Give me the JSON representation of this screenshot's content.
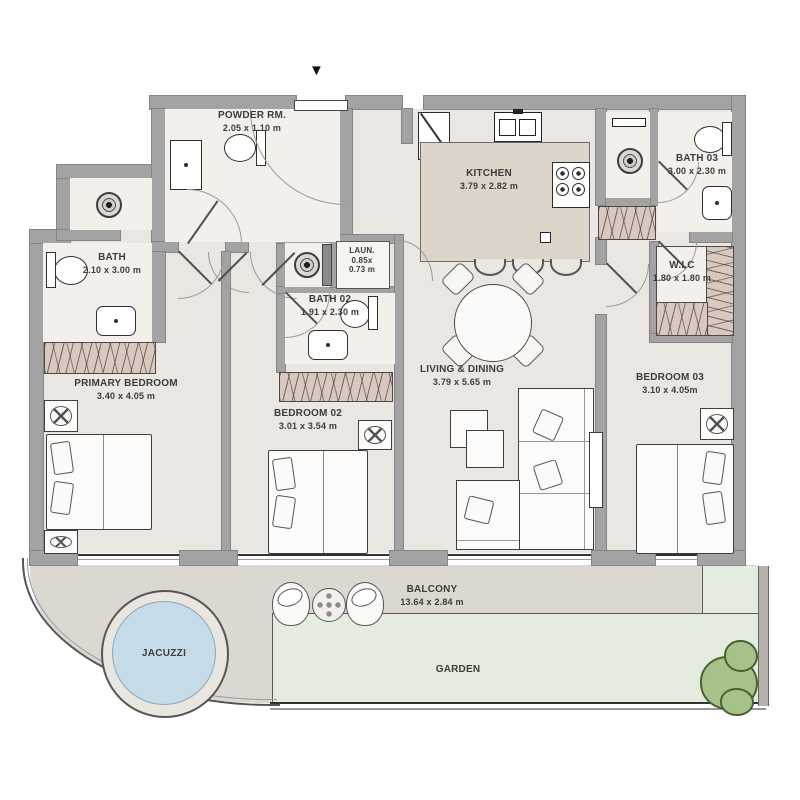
{
  "plan": {
    "entrance_marker": "▼",
    "rooms": {
      "powder": {
        "name": "POWDER RM.",
        "dims": "2.05 x 1.10 m"
      },
      "bath": {
        "name": "BATH",
        "dims": "2.10 x 3.00 m"
      },
      "laundry": {
        "name": "LAUN.",
        "dims_line1": "0.85x",
        "dims_line2": "0.73 m"
      },
      "bath02": {
        "name": "BATH 02",
        "dims": "1.91 x 2.30 m"
      },
      "bath03": {
        "name": "BATH 03",
        "dims": "3.00 x 2.30 m"
      },
      "wic": {
        "name": "W.I.C",
        "dims": "1.80 x 1.80 m"
      },
      "kitchen": {
        "name": "KITCHEN",
        "dims": "3.79 x 2.82 m"
      },
      "living": {
        "name": "LIVING & DINING",
        "dims": "3.79 x 5.65 m"
      },
      "primary": {
        "name": "PRIMARY BEDROOM",
        "dims": "3.40 x 4.05 m"
      },
      "bedroom02": {
        "name": "BEDROOM 02",
        "dims": "3.01 x 3.54 m"
      },
      "bedroom03": {
        "name": "BEDROOM 03",
        "dims": "3.10 x 4.05m"
      },
      "balcony": {
        "name": "BALCONY",
        "dims": "13.64 x 2.84 m"
      },
      "garden": {
        "name": "GARDEN"
      },
      "jacuzzi": {
        "name": "JACUZZI"
      }
    },
    "colors": {
      "wall": "#a3a3a3",
      "floor": "#eae6e1",
      "room_light": "#f3f0ec",
      "island": "#ddd5c9",
      "wardrobe": "#d8c8bf",
      "balcony_floor": "#dcd7d0",
      "garden": "#e4ecdf",
      "jacuzzi_water": "#c6dde9",
      "bush": "#a6c18a",
      "text": "#3c3c3c"
    }
  }
}
